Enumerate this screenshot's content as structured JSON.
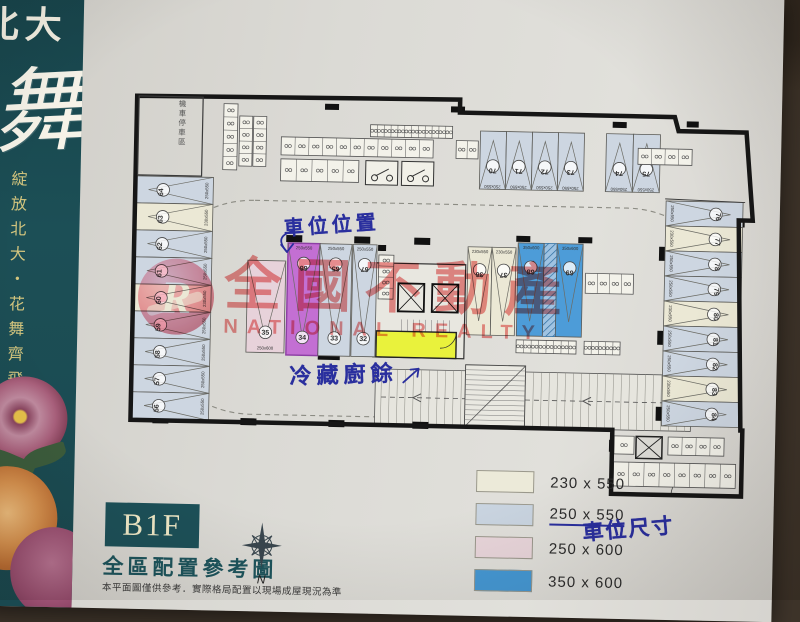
{
  "sidebar": {
    "project": "北大",
    "calligraphy": "舞",
    "tagline": "綻放北大・花舞齊飛"
  },
  "titleblock": {
    "floor": "B1F",
    "caption": "全區配置參考圖",
    "disclaimer": "本平面圖僅供參考．實際格局配置以現場成屋現況為準",
    "compass_label": "N"
  },
  "watermark": {
    "logo_letter": "R",
    "title": "全國不動產",
    "subtitle": "NATIONAL REALTY"
  },
  "annotations": {
    "stall_location": "車位位置",
    "cold_kitchen_waste": "冷藏廚餘",
    "stall_size_note": "車位尺寸"
  },
  "theme": {
    "banner_teal": "#1c4f56",
    "accent_gold": "#d3c57e",
    "highlight_yellow": "#e9f23c",
    "highlight_purple": "#c36fd3",
    "ink_blue": "#2a2f9e",
    "watermark_red": "#e22b2b"
  },
  "legend": {
    "items": [
      {
        "size": "230 x 550",
        "color": "#ecead9",
        "underline": false
      },
      {
        "size": "250 x 550",
        "color": "#c9d4e0",
        "underline": true
      },
      {
        "size": "250 x 600",
        "color": "#e8d5da",
        "underline": false
      },
      {
        "size": "350 x 600",
        "color": "#4598d4",
        "underline": false
      }
    ]
  },
  "plan": {
    "room_label": "機車停車區",
    "size_by_color": {
      "blue": "250x550",
      "cream": "230x550",
      "pink": "250x600",
      "deep": "350x600",
      "purple": "250x550"
    },
    "stall_groups": [
      {
        "id": "left-column",
        "dir": "right",
        "x": 19,
        "y": 96,
        "len": 77,
        "w": 27,
        "stalls": [
          {
            "n": "64",
            "c": "blue"
          },
          {
            "n": "63",
            "c": "cream"
          },
          {
            "n": "62",
            "c": "blue"
          },
          {
            "n": "61",
            "c": "blue"
          },
          {
            "n": "60",
            "c": "cream"
          },
          {
            "n": "59",
            "c": "blue"
          },
          {
            "n": "58",
            "c": "blue"
          },
          {
            "n": "57",
            "c": "blue"
          },
          {
            "n": "56",
            "c": "blue"
          }
        ]
      },
      {
        "id": "right-column",
        "dir": "left",
        "x": 549,
        "y": 110,
        "len": 77,
        "w": 25,
        "stalls": [
          {
            "n": "76",
            "c": "blue"
          },
          {
            "n": "77",
            "c": "cream"
          },
          {
            "n": "78",
            "c": "blue"
          },
          {
            "n": "79",
            "c": "blue"
          },
          {
            "n": "80",
            "c": "cream"
          },
          {
            "n": "81",
            "c": "blue"
          },
          {
            "n": "82",
            "c": "blue"
          },
          {
            "n": "83",
            "c": "cream"
          },
          {
            "n": "84",
            "c": "blue"
          }
        ]
      },
      {
        "id": "top-row-a",
        "dir": "down",
        "x": 362,
        "y": 44,
        "len": 58,
        "w": 26,
        "stalls": [
          {
            "n": "70",
            "c": "blue"
          },
          {
            "n": "71",
            "c": "blue"
          },
          {
            "n": "72",
            "c": "blue"
          },
          {
            "n": "73",
            "c": "blue"
          }
        ]
      },
      {
        "id": "top-row-b",
        "dir": "down",
        "x": 488,
        "y": 44,
        "len": 58,
        "w": 27,
        "stalls": [
          {
            "n": "74",
            "c": "blue"
          },
          {
            "n": "75",
            "c": "blue"
          }
        ]
      },
      {
        "id": "island-pink",
        "dir": "up",
        "x": 132,
        "y": 178,
        "len": 92,
        "w": 38,
        "stalls": [
          {
            "n": "35",
            "c": "pink",
            "pos": "b"
          }
        ]
      },
      {
        "id": "island-a",
        "dir": "up",
        "x": 172,
        "y": 160,
        "len": 112,
        "w": 32,
        "stalls": [
          {
            "n": "66",
            "n2": "34",
            "c": "purple"
          },
          {
            "n": "65",
            "n2": "33",
            "c": "blue"
          }
        ]
      },
      {
        "id": "island-b",
        "dir": "up",
        "x": 237,
        "y": 160,
        "len": 112,
        "w": 24,
        "stalls": [
          {
            "n": "67",
            "n2": "32",
            "c": "blue"
          }
        ]
      },
      {
        "id": "island-cream",
        "dir": "up",
        "x": 352,
        "y": 160,
        "len": 88,
        "w": 24,
        "stalls": [
          {
            "n": "36",
            "c": "cream"
          },
          {
            "n": "37",
            "c": "cream"
          }
        ]
      },
      {
        "id": "island-accessible",
        "dir": "up",
        "xs": [
          402,
          441
        ],
        "y": 155,
        "len": 93,
        "w": 26,
        "stalls": [
          {
            "n": "68",
            "c": "deep"
          },
          {
            "n": "69",
            "c": "deep"
          }
        ]
      }
    ],
    "scooter_strips": [
      {
        "x": 105,
        "y": 22,
        "w": 14,
        "h": 66,
        "vert": true,
        "n": 5
      },
      {
        "x": 121,
        "y": 34,
        "w": 13,
        "h": 50,
        "vert": true,
        "n": 4
      },
      {
        "x": 135,
        "y": 34,
        "w": 13,
        "h": 50,
        "vert": true,
        "n": 4
      },
      {
        "x": 163,
        "y": 54,
        "w": 152,
        "h": 18,
        "n": 11
      },
      {
        "x": 163,
        "y": 76,
        "w": 78,
        "h": 22,
        "n": 5
      },
      {
        "x": 252,
        "y": 40,
        "w": 82,
        "h": 12,
        "n": 12
      },
      {
        "x": 338,
        "y": 54,
        "w": 22,
        "h": 18,
        "n": 2
      },
      {
        "x": 263,
        "y": 170,
        "w": 15,
        "h": 44,
        "vert": true,
        "n": 4
      },
      {
        "x": 402,
        "y": 252,
        "w": 60,
        "h": 13,
        "n": 8
      },
      {
        "x": 470,
        "y": 252,
        "w": 36,
        "h": 13,
        "n": 5
      },
      {
        "x": 470,
        "y": 184,
        "w": 48,
        "h": 20,
        "n": 4
      },
      {
        "x": 520,
        "y": 58,
        "w": 54,
        "h": 16,
        "n": 4
      },
      {
        "x": 556,
        "y": 346,
        "w": 56,
        "h": 18,
        "n": 4
      },
      {
        "x": 502,
        "y": 372,
        "w": 122,
        "h": 24,
        "n": 8
      },
      {
        "x": 502,
        "y": 346,
        "w": 20,
        "h": 18,
        "n": 1
      }
    ]
  }
}
